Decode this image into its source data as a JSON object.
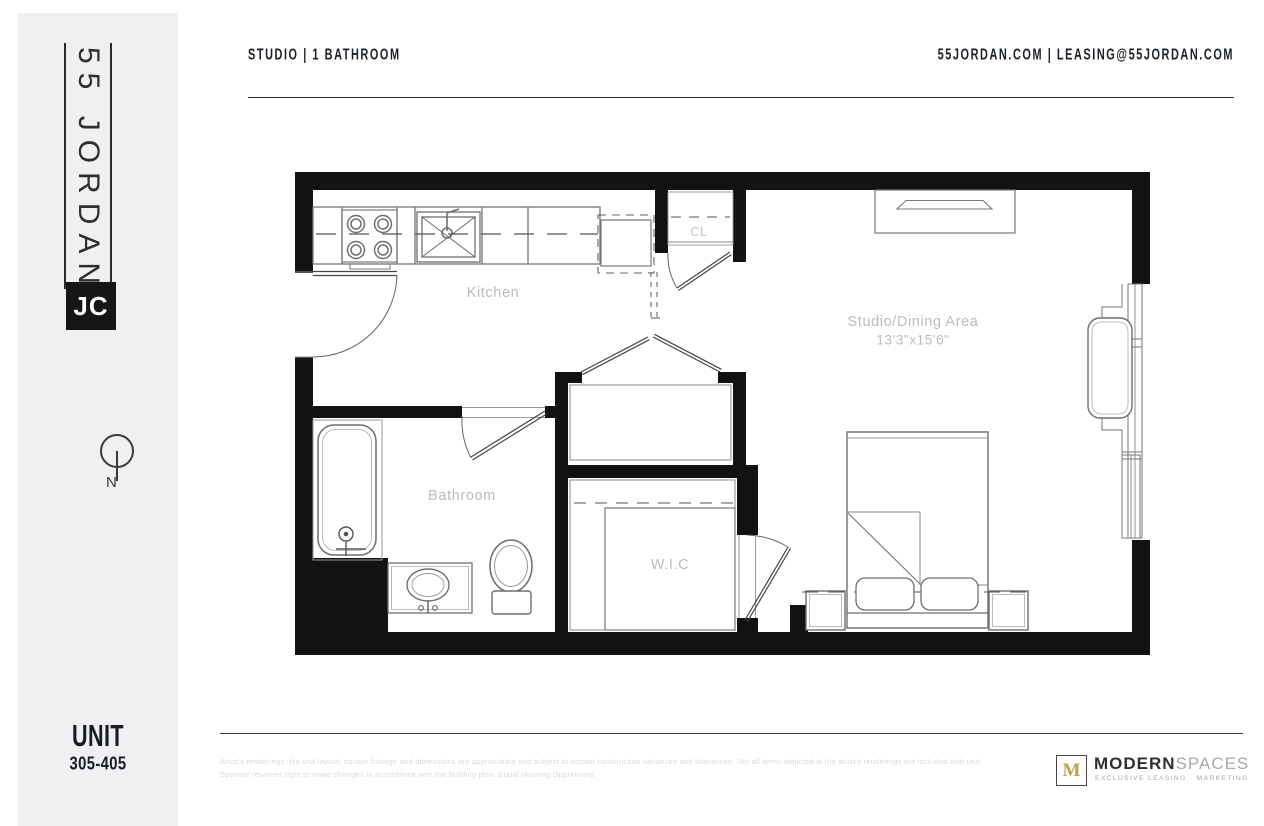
{
  "sidebar": {
    "brand_vertical": "55 JORDAN",
    "brand_logo": "JC",
    "compass_label": "N",
    "unit_label": "UNIT",
    "unit_number": "305-405"
  },
  "header": {
    "left": "STUDIO  |  1 BATHROOM",
    "right": "55JORDAN.COM  |  LEASING@55JORDAN.COM"
  },
  "floorplan": {
    "labels": {
      "kitchen": "Kitchen",
      "closet": "CL",
      "studio": "Studio/Dining Area",
      "studio_dimensions": "13'3\"x15'6\"",
      "bathroom": "Bathroom",
      "wic": "W.I.C"
    }
  },
  "footer": {
    "disclaimer_line1": "Artist's renderings, the unit layout, square footage and dimensions are approximate and subject to normal construction variances and tolerances. Not all items depicted in the artist's renderings are included with unit.",
    "disclaimer_line2": "Sponsor reserves right to make changes in accordance with the building plan. Equal Housing Opportunity.",
    "agency": {
      "mark": "M",
      "name_bold": "MODERN",
      "name_light": "SPACES",
      "tagline": "EXCLUSIVE LEASING · MARKETING"
    }
  },
  "colors": {
    "wall": "#121212",
    "sidebar_bg": "#f0f0f2",
    "gold": "#c3a144",
    "label_gray": "#bcbcbc",
    "text_dark": "#1b2026"
  }
}
